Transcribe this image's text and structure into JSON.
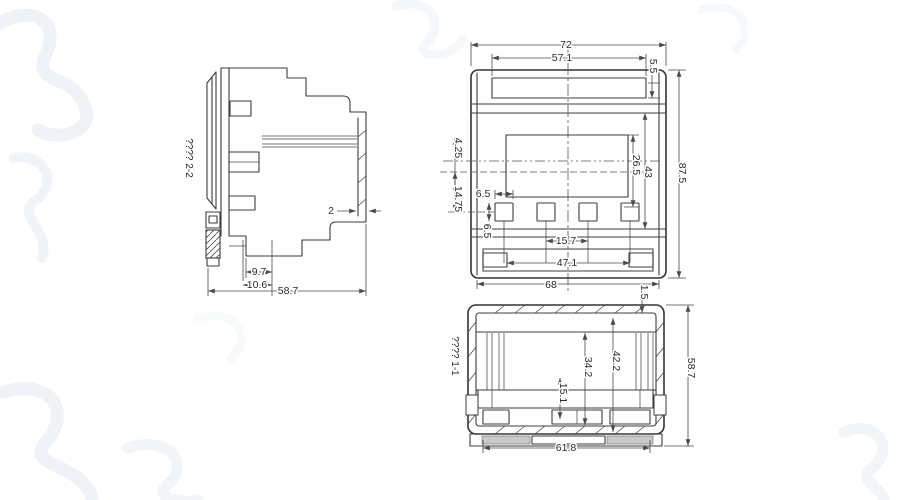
{
  "drawing": {
    "background": "#ffffff",
    "line_color": "#3d3d3d",
    "dim_color": "#4a4a4a",
    "watermark_color": "#e6edf3",
    "pad_color": "#c9c9c9"
  },
  "side_view": {
    "section_label": "???? 2-2",
    "dim_wall_thickness": "2",
    "dim_9_7": "9.7",
    "dim_10_6": "10.6",
    "dim_58_7": "58.7"
  },
  "front_view": {
    "dim_72": "72",
    "dim_57_1": "57.1",
    "dim_5_5": "5.5",
    "dim_87_5": "87.5",
    "dim_43": "43",
    "dim_26_5": "26.5",
    "dim_4_25": "4.25",
    "dim_14_75": "14.75",
    "dim_6_5_width": "6.5",
    "dim_6_5_height": "6.5",
    "dim_15_7": "15.7",
    "dim_47_1": "47.1",
    "dim_68": "68"
  },
  "bottom_view": {
    "section_label": "???? 1-1",
    "dim_1_5": "1.5",
    "dim_58_7": "58.7",
    "dim_42_2": "42.2",
    "dim_34_2": "34.2",
    "dim_15_1": "15.1",
    "dim_61_8": "61.8"
  }
}
